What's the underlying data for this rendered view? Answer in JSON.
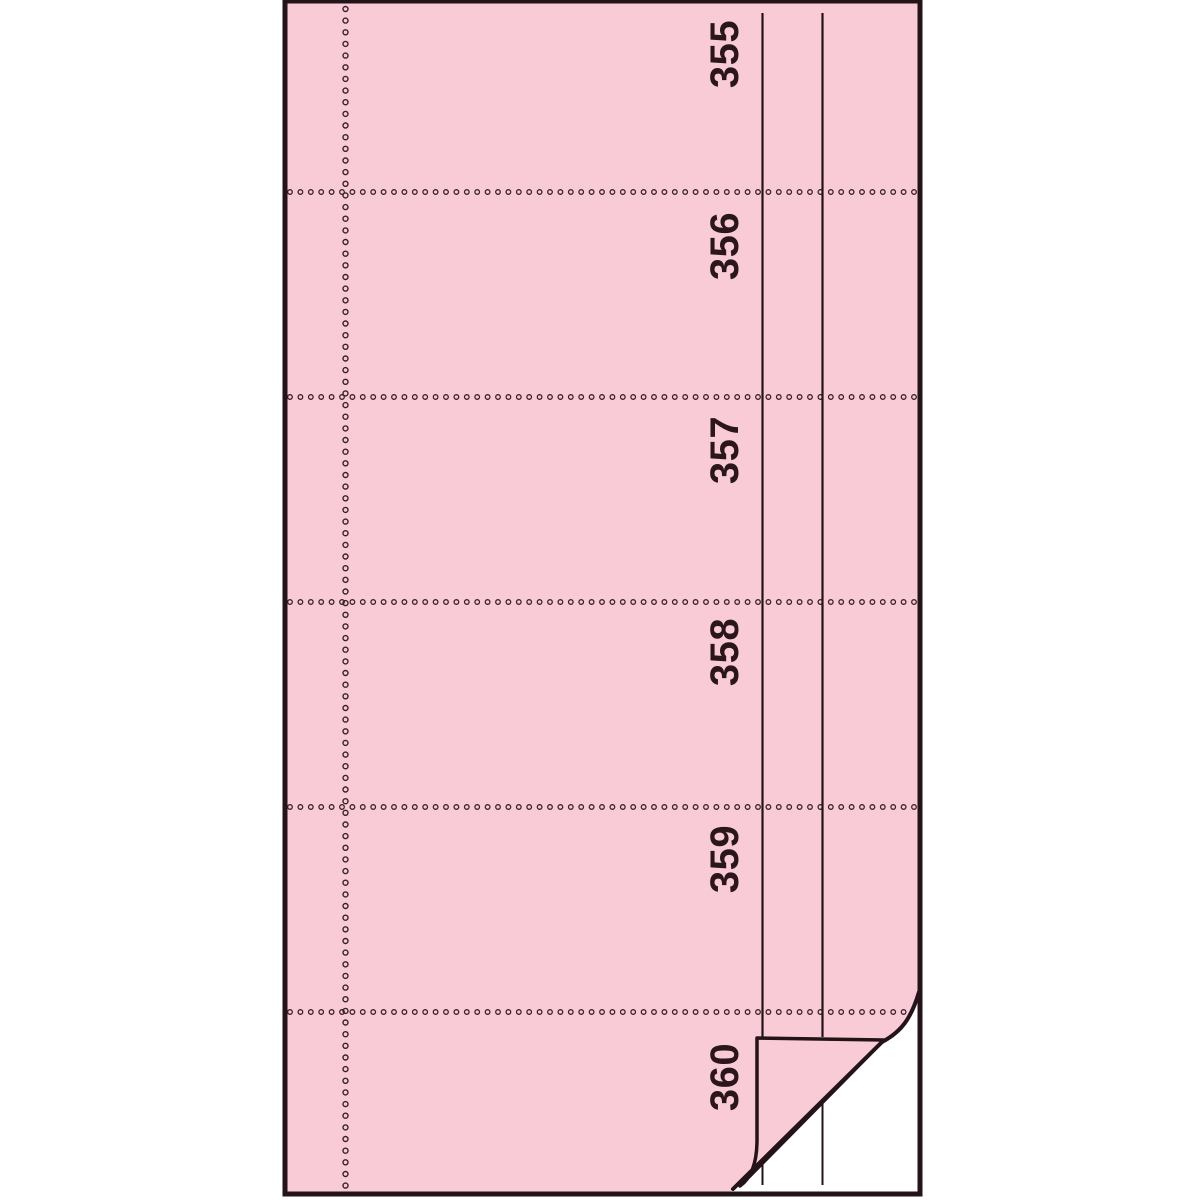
{
  "photo": {
    "description": "Pink perforated voucher-book page with six numbered stubs; bottom-right corner curled up revealing the white copy page underneath",
    "section_numbers": [
      "355",
      "356",
      "357",
      "358",
      "359",
      "360"
    ],
    "colors": {
      "background": "#ffffff",
      "paper_pink": "#f9cbd6",
      "under_page": "#ffffff",
      "ink_dark": "#241318",
      "number_ink": "#2b161c",
      "perforation_ring": "#3b2129"
    }
  }
}
